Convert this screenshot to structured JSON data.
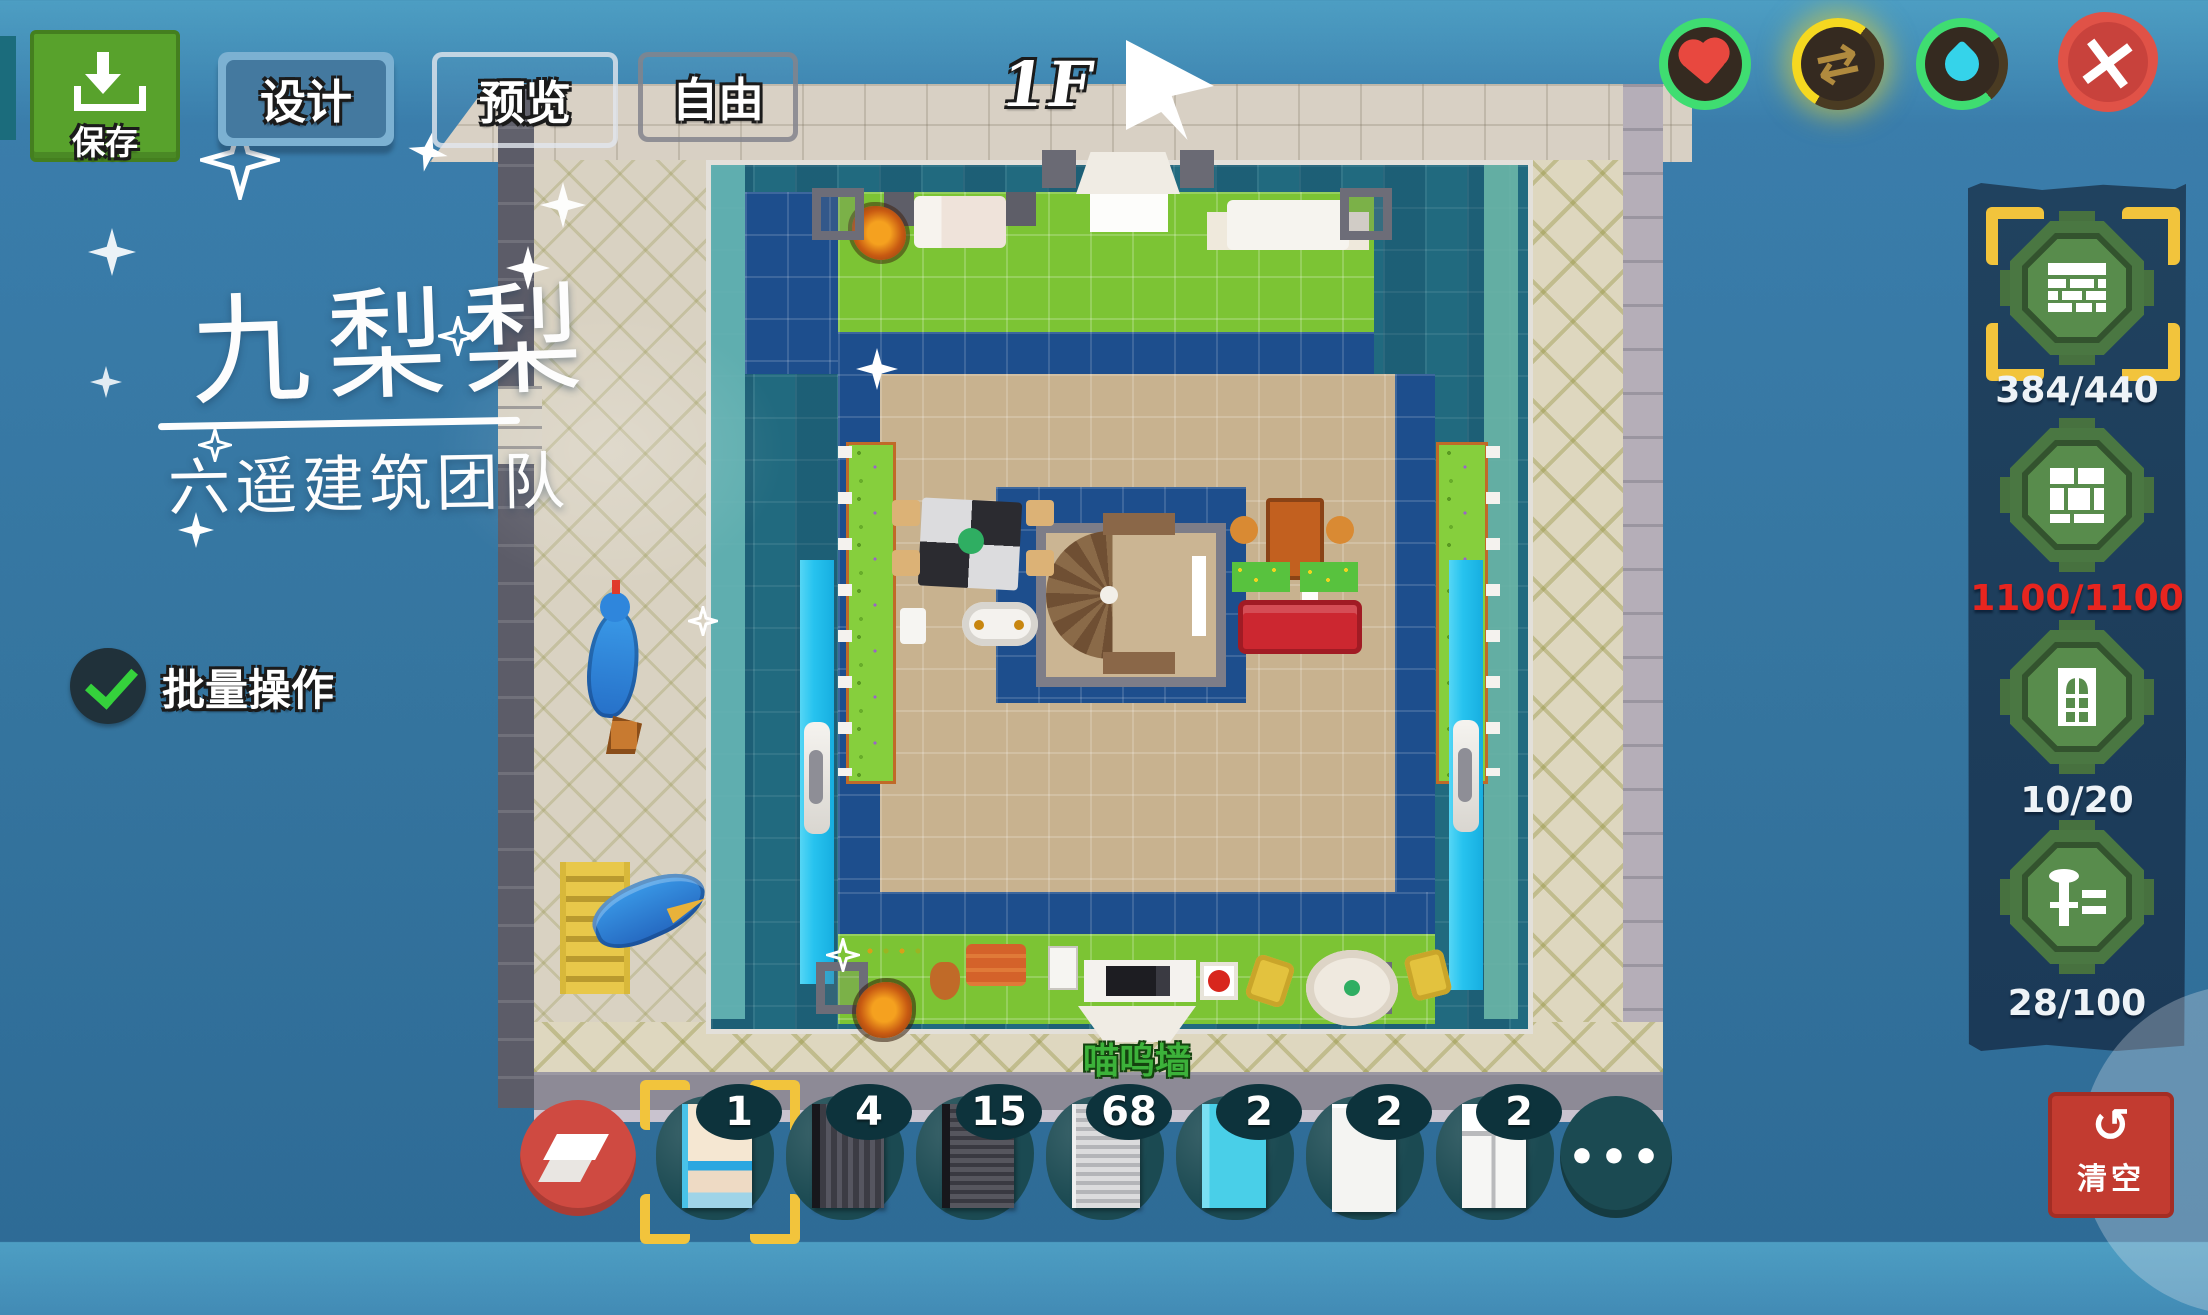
{
  "toolbar": {
    "save_label": "保存",
    "tabs": [
      {
        "label": "设计",
        "active": true
      },
      {
        "label": "预览",
        "active": false
      },
      {
        "label": "自由",
        "active": false
      }
    ],
    "floor_label": "1F"
  },
  "watermark": {
    "title": "九梨梨",
    "subtitle": "六遥建筑团队"
  },
  "batch_toggle": {
    "label": "批量操作",
    "checked": true
  },
  "resource_panel": {
    "items": [
      {
        "name": "walls",
        "count": "384/440",
        "selected": true,
        "alert": false
      },
      {
        "name": "floors",
        "count": "1100/1100",
        "selected": false,
        "alert": true
      },
      {
        "name": "doors-windows",
        "count": "10/20",
        "selected": false,
        "alert": false
      },
      {
        "name": "furniture",
        "count": "28/100",
        "selected": false,
        "alert": false
      }
    ]
  },
  "hotbar": {
    "slots": [
      {
        "count": "1",
        "selected": true
      },
      {
        "count": "4",
        "selected": false
      },
      {
        "count": "15",
        "selected": false
      },
      {
        "count": "68",
        "selected": false
      },
      {
        "count": "2",
        "selected": false
      },
      {
        "count": "2",
        "selected": false
      },
      {
        "count": "2",
        "selected": false
      }
    ],
    "more_label": "•••"
  },
  "clear_button": {
    "label": "清空"
  },
  "scene": {
    "wall_sign": "喵呜墙"
  },
  "colors": {
    "selection_yellow": "#f2c43c",
    "alert_red": "#e8251f",
    "panel_navy": "#1d3d5b",
    "pool_teal": "#216a7f",
    "grass_green": "#7cc434",
    "floor_tan": "#c8b28f",
    "tile_navy": "#1d4e8d",
    "water_cyan": "#27c3ef",
    "save_green": "#58a22c",
    "danger_red": "#c23b30"
  }
}
